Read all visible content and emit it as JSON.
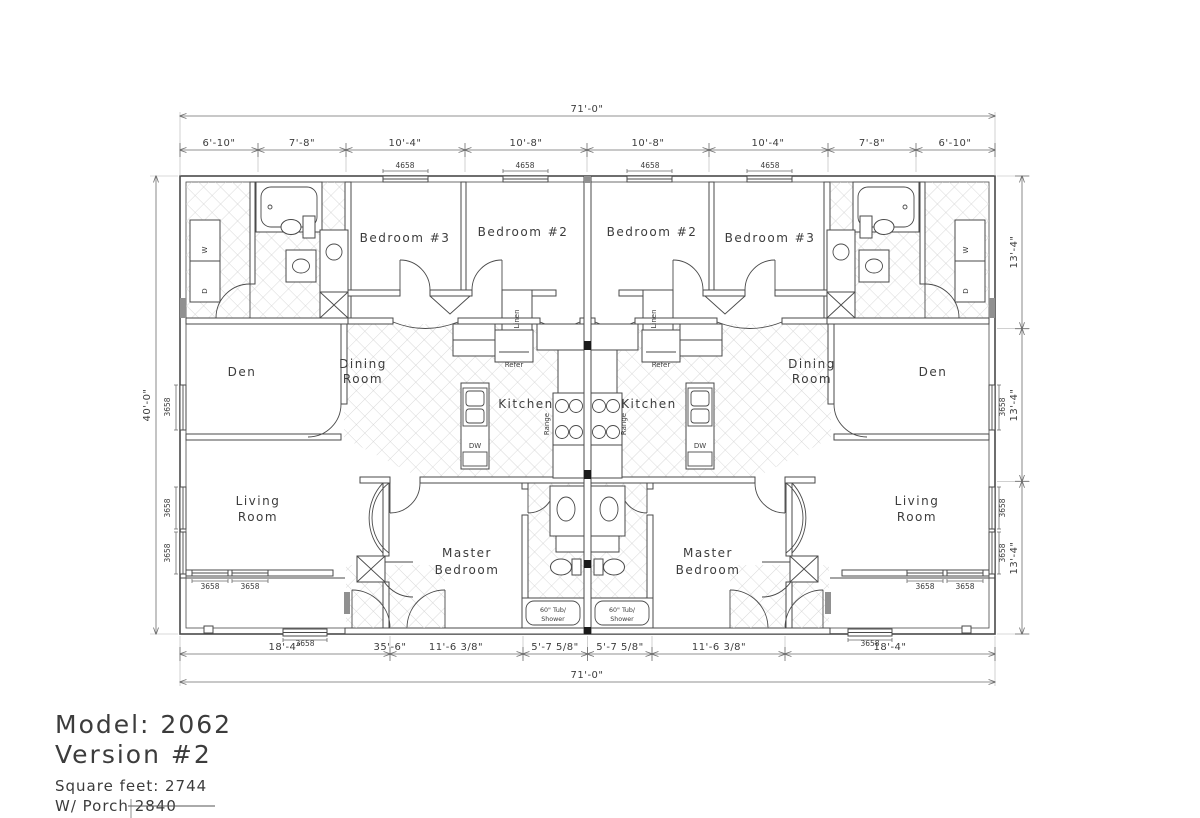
{
  "title_block": {
    "model": "Model: 2062",
    "version": "Version #2",
    "sqft": "Square feet: 2744",
    "porch": "W/ Porch 2840"
  },
  "dimensions": {
    "overall_width": "71'-0\"",
    "overall_depth": "40'-0\"",
    "bottom_overall": "71'-0\"",
    "top_segments": [
      "6'-10\"",
      "7'-8\"",
      "10'-4\"",
      "10'-8\"",
      "10'-8\"",
      "10'-4\"",
      "7'-8\"",
      "6'-10\""
    ],
    "right_segments": [
      "13'-4\"",
      "13'-4\"",
      "13'-4\""
    ],
    "bottom_segments": [
      "18'-4\"",
      "35'-6\"",
      "11'-6 3/8\"",
      "5'-7 5/8\"",
      "5'-7 5/8\"",
      "11'-6 3/8\"",
      "18'-4\""
    ]
  },
  "rooms": {
    "bedroom3": "Bedroom #3",
    "bedroom2": "Bedroom #2",
    "den": "Den",
    "dining1": "Dining",
    "dining2": "Room",
    "kitchen": "Kitchen",
    "living1": "Living",
    "living2": "Room",
    "master1": "Master",
    "master2": "Bedroom"
  },
  "fixtures": {
    "refer": "Refer",
    "range": "Range",
    "dw": "DW",
    "linen": "Linen",
    "washer": "W",
    "dryer": "D",
    "tub1": "60\" Tub/",
    "tub2": "Shower"
  },
  "windows": {
    "top": "4658",
    "side": "3658"
  }
}
